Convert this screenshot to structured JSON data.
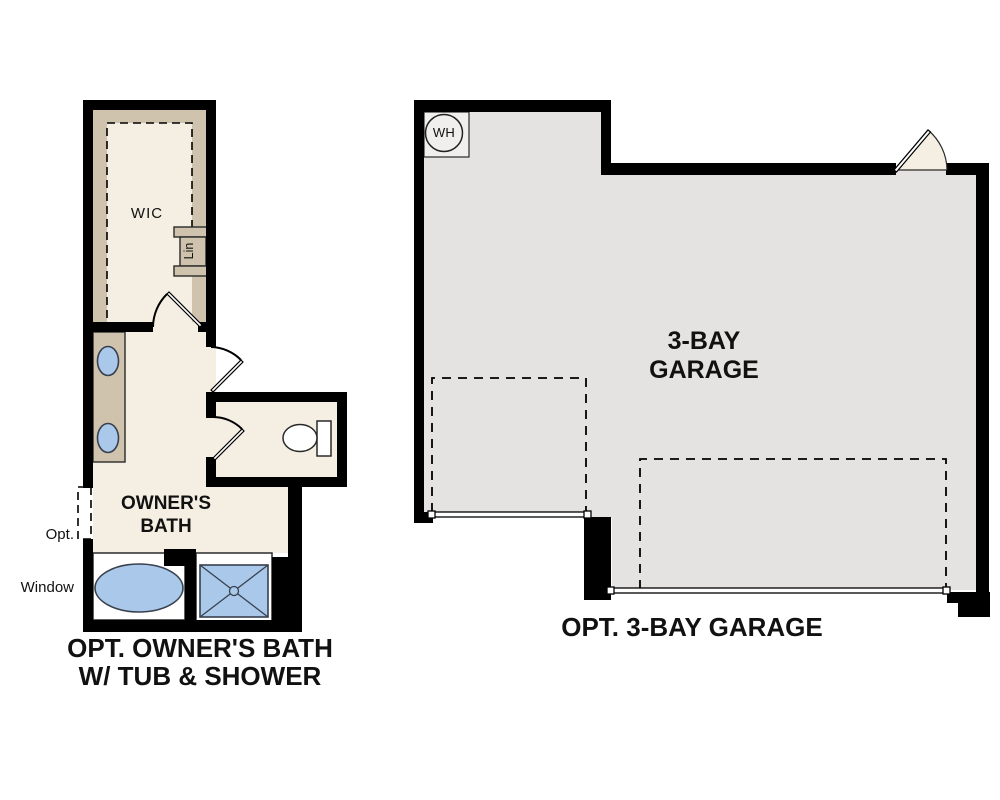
{
  "colors": {
    "wall": "#000000",
    "cream": "#f5efe3",
    "tan": "#cfc3ad",
    "garage": "#e4e3e1",
    "wh": "#f0efed",
    "blue": "#aac9ea",
    "outline": "#2a2a2a",
    "text": "#111111"
  },
  "bath_plan": {
    "wic_label": "WIC",
    "linen_label": "Lin",
    "room_line1": "OWNER'S",
    "room_line2": "BATH",
    "window_line1": "Opt.",
    "window_line2": "Window",
    "caption_line1": "OPT. OWNER'S BATH",
    "caption_line2": "W/ TUB & SHOWER",
    "fixtures": [
      "double-vanity",
      "tub",
      "shower",
      "toilet",
      "linen-closet",
      "optional-window"
    ]
  },
  "garage_plan": {
    "room_line1": "3-BAY",
    "room_line2": "GARAGE",
    "water_heater_label": "WH",
    "caption": "OPT. 3-BAY GARAGE",
    "fixtures": [
      "water-heater",
      "garage-door-single",
      "garage-door-double",
      "house-entry-door"
    ]
  }
}
